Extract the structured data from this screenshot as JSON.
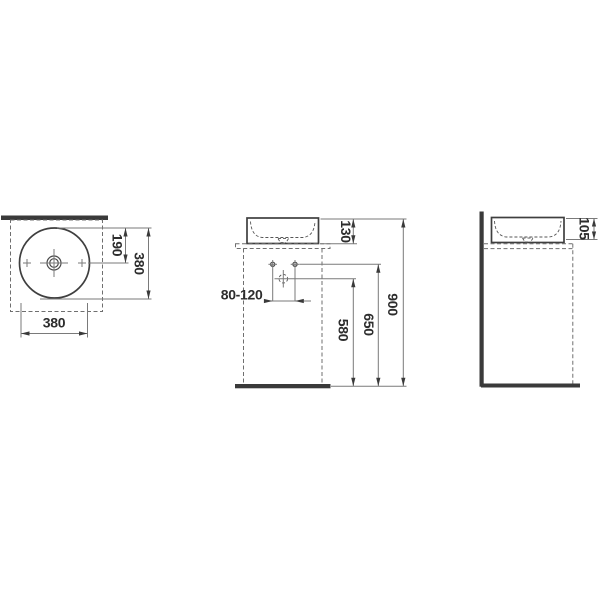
{
  "drawing": {
    "type": "sanitaryware-dimension-drawing",
    "description": "Three-view technical drawing of a round countertop washbasin bowl with dashed cabinet outline, wall and floor sections",
    "units": "mm",
    "colors": {
      "background": "#ffffff",
      "object_line": "#3f3f3f",
      "dimension_line": "#7a7a7a",
      "dashed_line": "#6f6f6f",
      "solid_section": "#3a3a3a",
      "text": "#2d2d2d"
    },
    "views": {
      "top": {
        "name": "top view",
        "dim_center_offset": "190",
        "dim_diameter_vertical": "380",
        "dim_diameter_horizontal": "380"
      },
      "front": {
        "name": "front view",
        "dim_basin_height": "130",
        "dim_faucet_range": "80-120",
        "dim_drain_height": "580",
        "dim_faucet_height": "650",
        "dim_overall_height": "900"
      },
      "side": {
        "name": "side view",
        "dim_bowl_depth": "105"
      }
    }
  }
}
